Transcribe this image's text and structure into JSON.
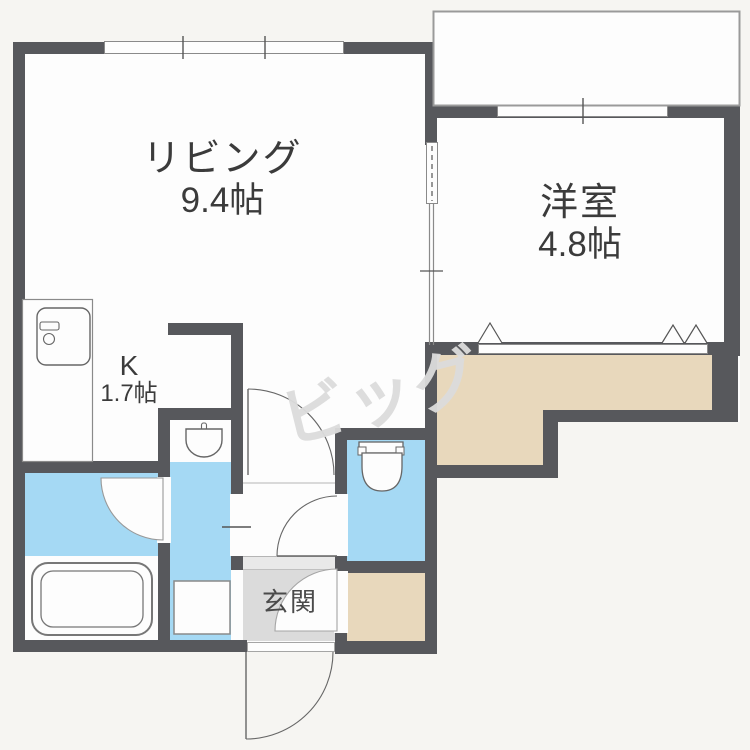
{
  "plan": {
    "title": "1LDK floor plan",
    "rooms": {
      "living": {
        "name": "リビング",
        "size": "9.4帖"
      },
      "western": {
        "name": "洋室",
        "size": "4.8帖"
      },
      "kitchen": {
        "name": "K",
        "size": "1.7帖"
      },
      "entrance": {
        "name": "玄関"
      }
    },
    "watermark": "ビッグ",
    "colors": {
      "wall": "#57585c",
      "water": "#a5d9f4",
      "storage": "#e8d8bc",
      "entrance_floor": "#dbdbdb",
      "entrance_step": "#e9e9e9",
      "interior": "#fdfdfd",
      "background": "#f6f5f2",
      "watermark": "#dcdcdc",
      "line": "#666666",
      "label": "#3b3b3b"
    },
    "fixtures": [
      "refrigerator-icon",
      "kitchen-counter",
      "bathtub-icon",
      "bath-door-swing",
      "washbasin-icon",
      "washing-machine-pan",
      "toilet-icon",
      "hall-door-swing",
      "toilet-door-swing",
      "storage-door-swing",
      "entrance-door-swing",
      "closet-fold-marks",
      "balcony-outline",
      "window-band",
      "sliding-door"
    ]
  }
}
